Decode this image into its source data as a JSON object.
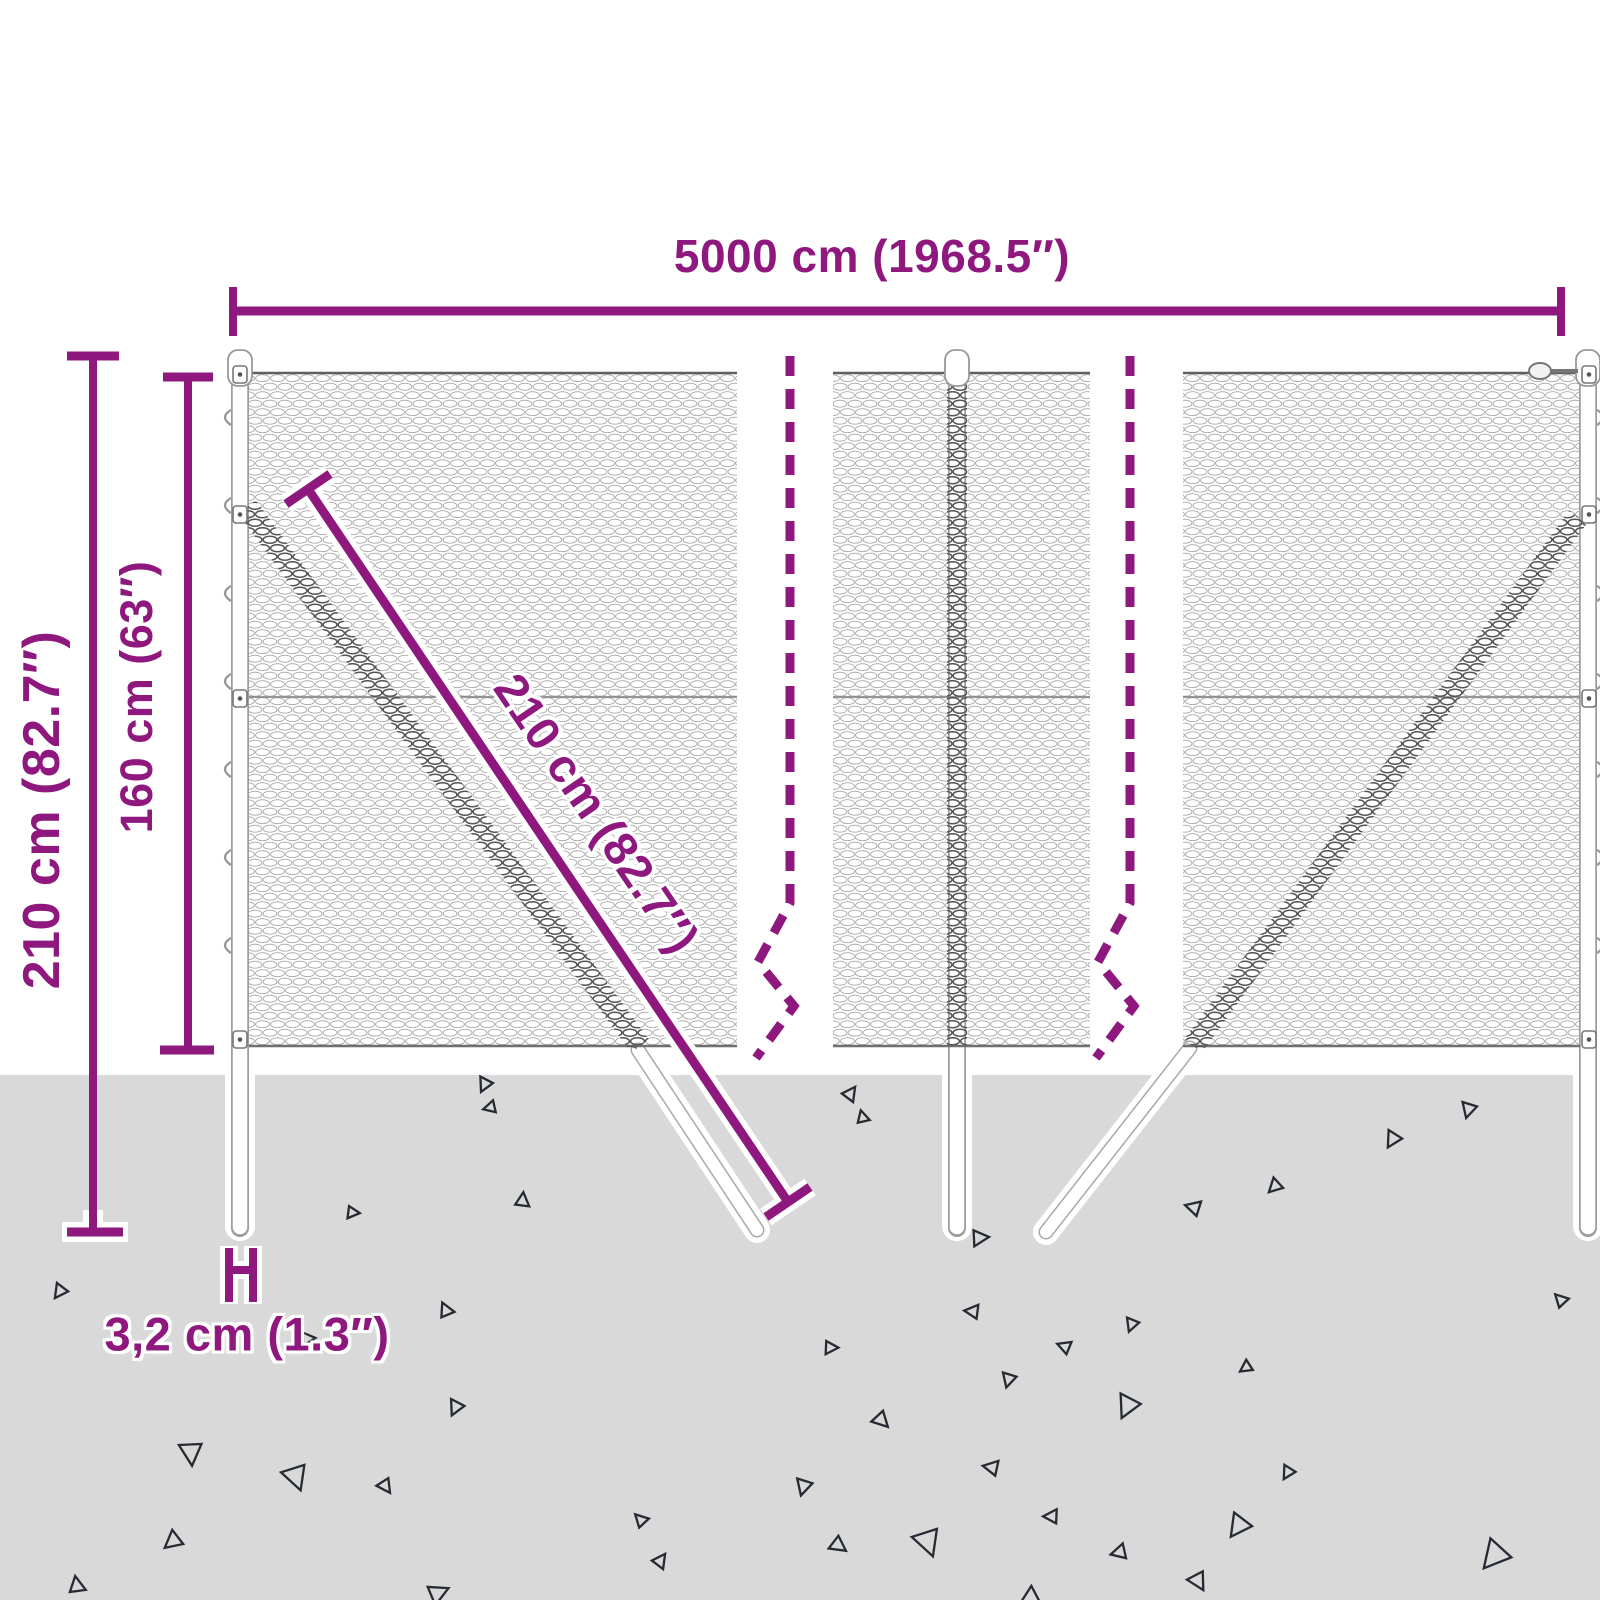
{
  "labels": {
    "width": "5000 cm (1968.5″)",
    "height_total": "210 cm (82.7″)",
    "height_mesh": "160 cm (63″)",
    "diagonal": "210 cm (82.7″)",
    "post_diameter": "3,2 cm (1.3″)"
  },
  "colors": {
    "accent": "#8E187E",
    "ground": "#D9D9D9",
    "mesh": "#A6A6A6",
    "mesh_dark": "#555555",
    "post_outline": "#9C9C9C",
    "triangle": "#262B33"
  },
  "ground": {
    "triangles": [
      [
        485,
        1085,
        10,
        15
      ],
      [
        850,
        1093,
        200,
        15
      ],
      [
        862,
        1117,
        150,
        13
      ],
      [
        1469,
        1110,
        0,
        16
      ],
      [
        1393,
        1140,
        15,
        17
      ],
      [
        1275,
        1187,
        30,
        15
      ],
      [
        1193,
        1208,
        90,
        16
      ],
      [
        980,
        1237,
        250,
        17
      ],
      [
        522,
        1200,
        170,
        15
      ],
      [
        353,
        1212,
        260,
        13
      ],
      [
        490,
        1108,
        60,
        13
      ],
      [
        60,
        1292,
        20,
        15
      ],
      [
        445,
        1310,
        140,
        15
      ],
      [
        308,
        1338,
        250,
        14
      ],
      [
        456,
        1408,
        10,
        16
      ],
      [
        192,
        1453,
        -20,
        24
      ],
      [
        297,
        1477,
        -35,
        26
      ],
      [
        386,
        1486,
        -50,
        15
      ],
      [
        173,
        1542,
        35,
        19
      ],
      [
        76,
        1585,
        155,
        17
      ],
      [
        438,
        1592,
        230,
        21
      ],
      [
        972,
        1312,
        80,
        15
      ],
      [
        1132,
        1325,
        5,
        14
      ],
      [
        831,
        1347,
        255,
        14
      ],
      [
        1064,
        1347,
        95,
        14
      ],
      [
        1246,
        1368,
        40,
        13
      ],
      [
        1009,
        1380,
        0,
        15
      ],
      [
        882,
        1420,
        300,
        17
      ],
      [
        1128,
        1407,
        10,
        24
      ],
      [
        991,
        1468,
        85,
        16
      ],
      [
        804,
        1487,
        0,
        17
      ],
      [
        1288,
        1473,
        15,
        14
      ],
      [
        1051,
        1517,
        75,
        15
      ],
      [
        1239,
        1527,
        20,
        24
      ],
      [
        929,
        1542,
        325,
        28
      ],
      [
        839,
        1545,
        290,
        17
      ],
      [
        1119,
        1553,
        60,
        16
      ],
      [
        1199,
        1581,
        315,
        19
      ],
      [
        1030,
        1598,
        45,
        19
      ],
      [
        1495,
        1557,
        25,
        30
      ],
      [
        1560,
        1300,
        120,
        14
      ],
      [
        640,
        1520,
        120,
        14
      ],
      [
        660,
        1560,
        200,
        15
      ]
    ]
  }
}
